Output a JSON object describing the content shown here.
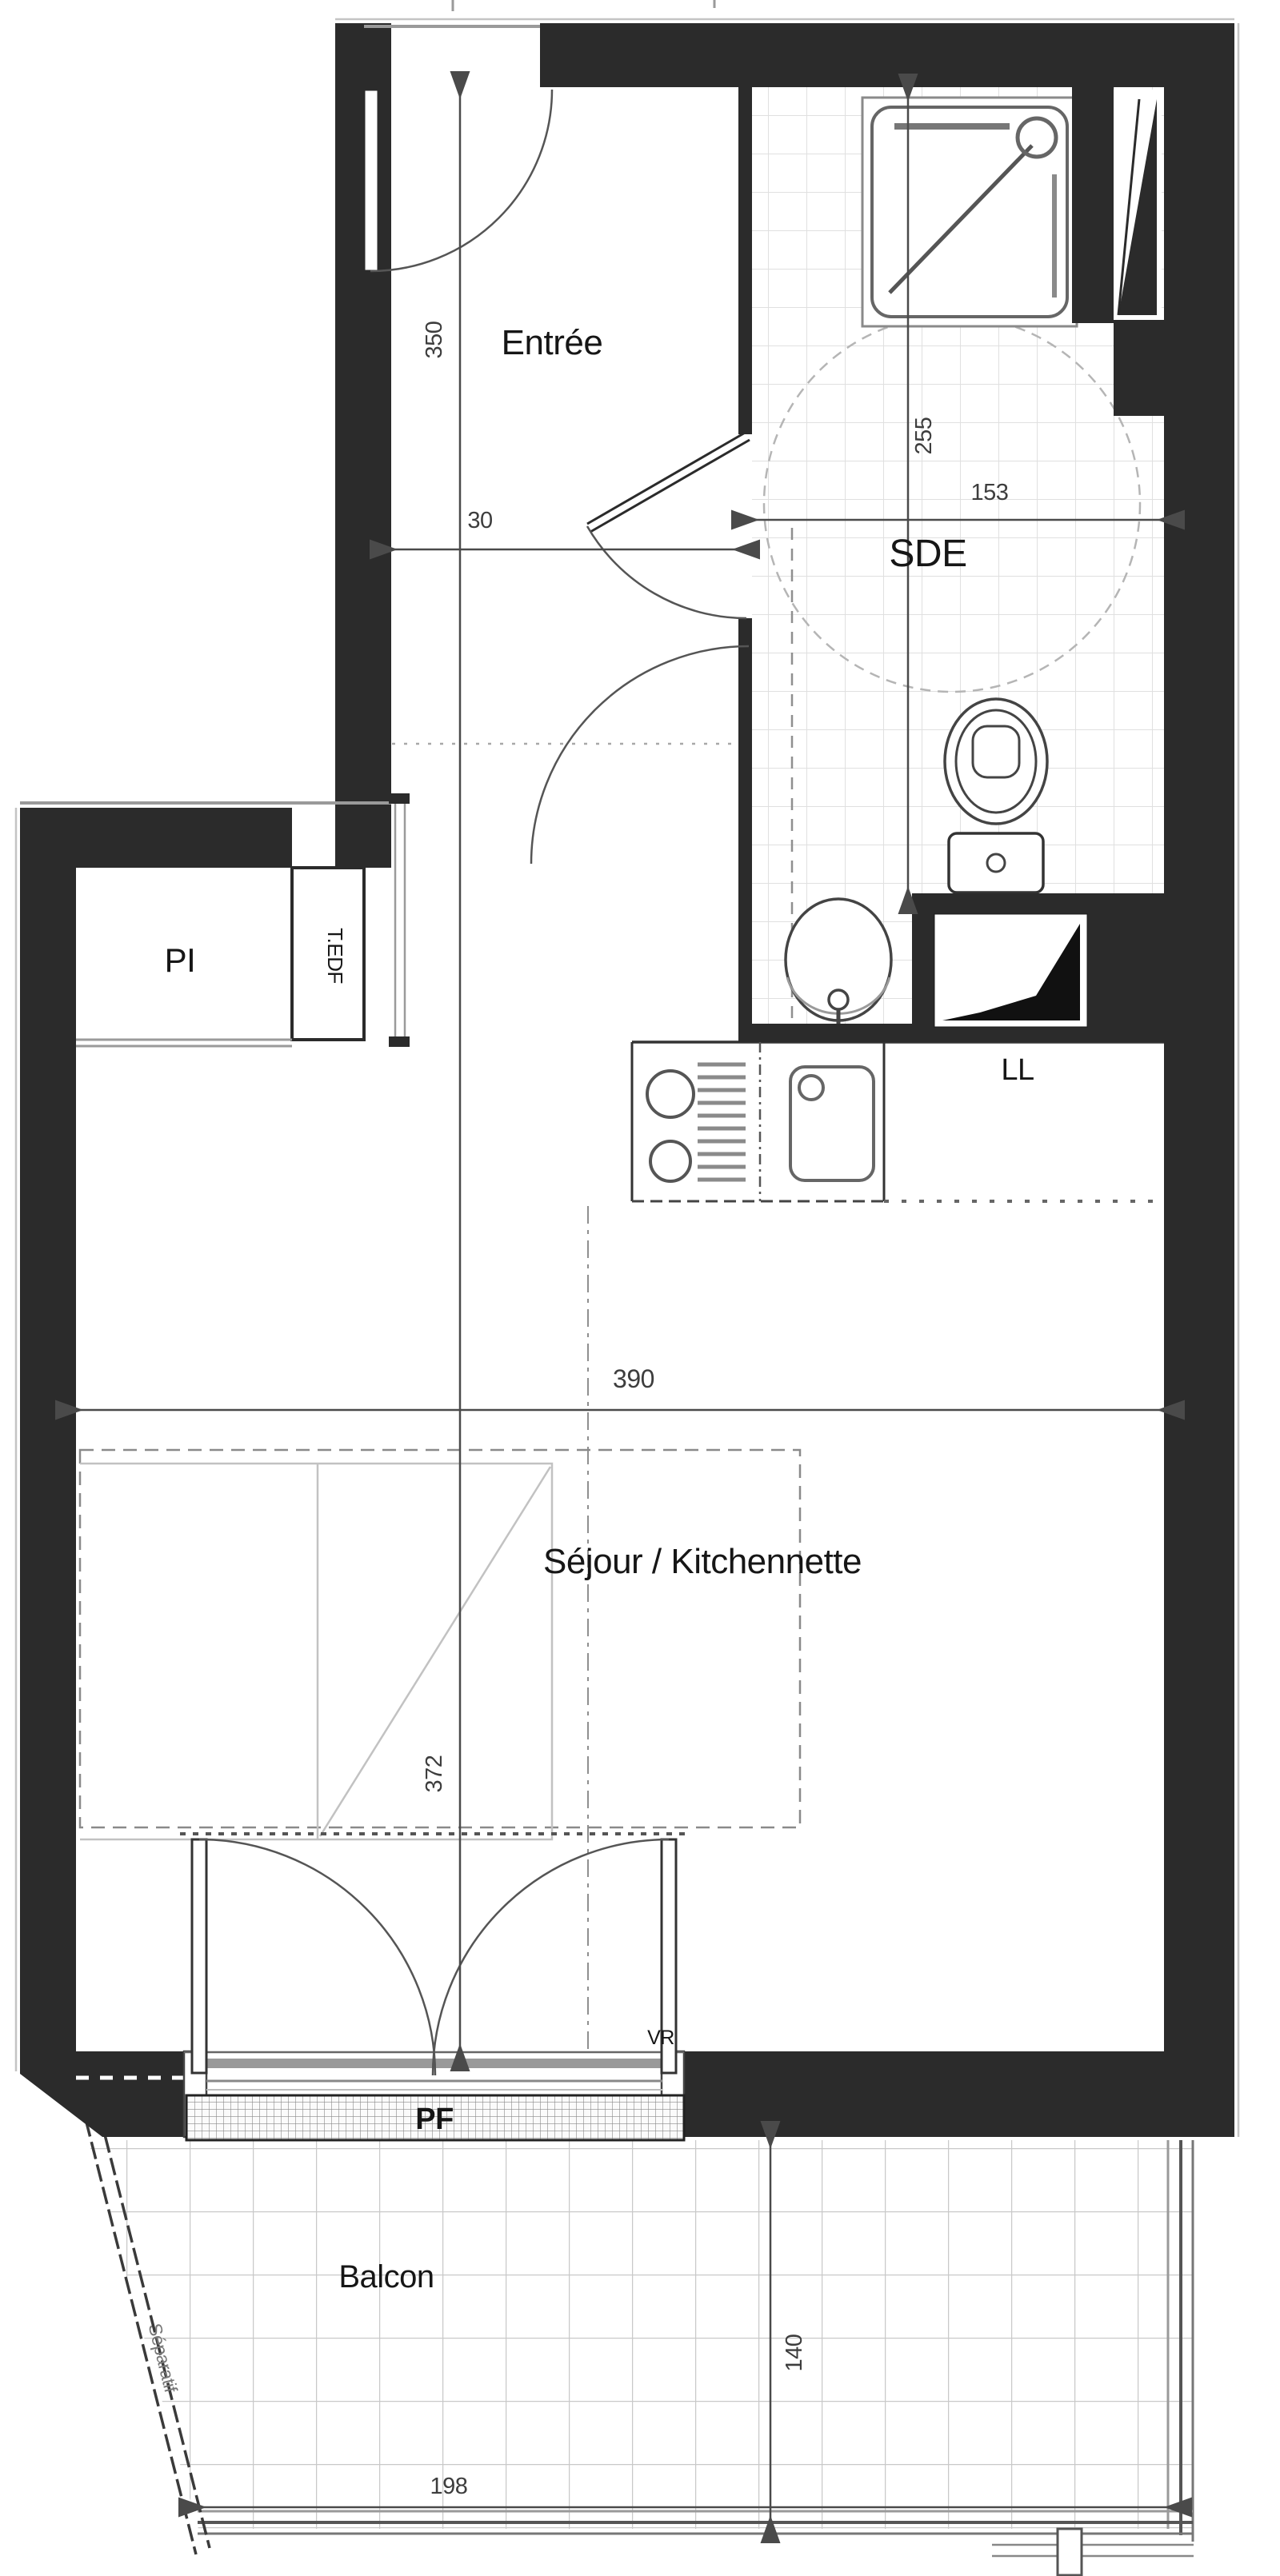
{
  "document": {
    "type": "apartment floor plan",
    "language": "fr"
  },
  "rooms": {
    "entree": {
      "label": "Entrée"
    },
    "sde": {
      "label": "SDE"
    },
    "pi": {
      "label": "PI"
    },
    "sejour": {
      "label": "Séjour / Kitchennette"
    },
    "balcon": {
      "label": "Balcon"
    }
  },
  "annotations": {
    "tedf": {
      "label": "T.EDF"
    },
    "ll": {
      "label": "LL"
    },
    "pf": {
      "label": "PF"
    },
    "vr": {
      "label": "VR"
    },
    "separatif": {
      "label": "Séparatif"
    }
  },
  "dimensions_cm": {
    "entree_depth": {
      "value": "350",
      "orientation": "vertical"
    },
    "entree_width": {
      "value": "30",
      "orientation": "horizontal"
    },
    "sde_width": {
      "value": "153",
      "orientation": "horizontal"
    },
    "sde_depth": {
      "value": "255",
      "orientation": "vertical"
    },
    "sejour_width": {
      "value": "390",
      "orientation": "horizontal"
    },
    "sejour_depth": {
      "value": "372",
      "orientation": "vertical"
    },
    "balcon_depth": {
      "value": "140",
      "orientation": "vertical"
    },
    "balcon_width": {
      "value": "198",
      "orientation": "horizontal"
    }
  },
  "colors": {
    "wall": "#2b2b2b",
    "dimension_line": "#4a4a4a",
    "sde_tile": "#e0e0e0",
    "balcony_tile": "#c9c9c9",
    "furniture": "#c2c2c2",
    "text": "#161616"
  }
}
